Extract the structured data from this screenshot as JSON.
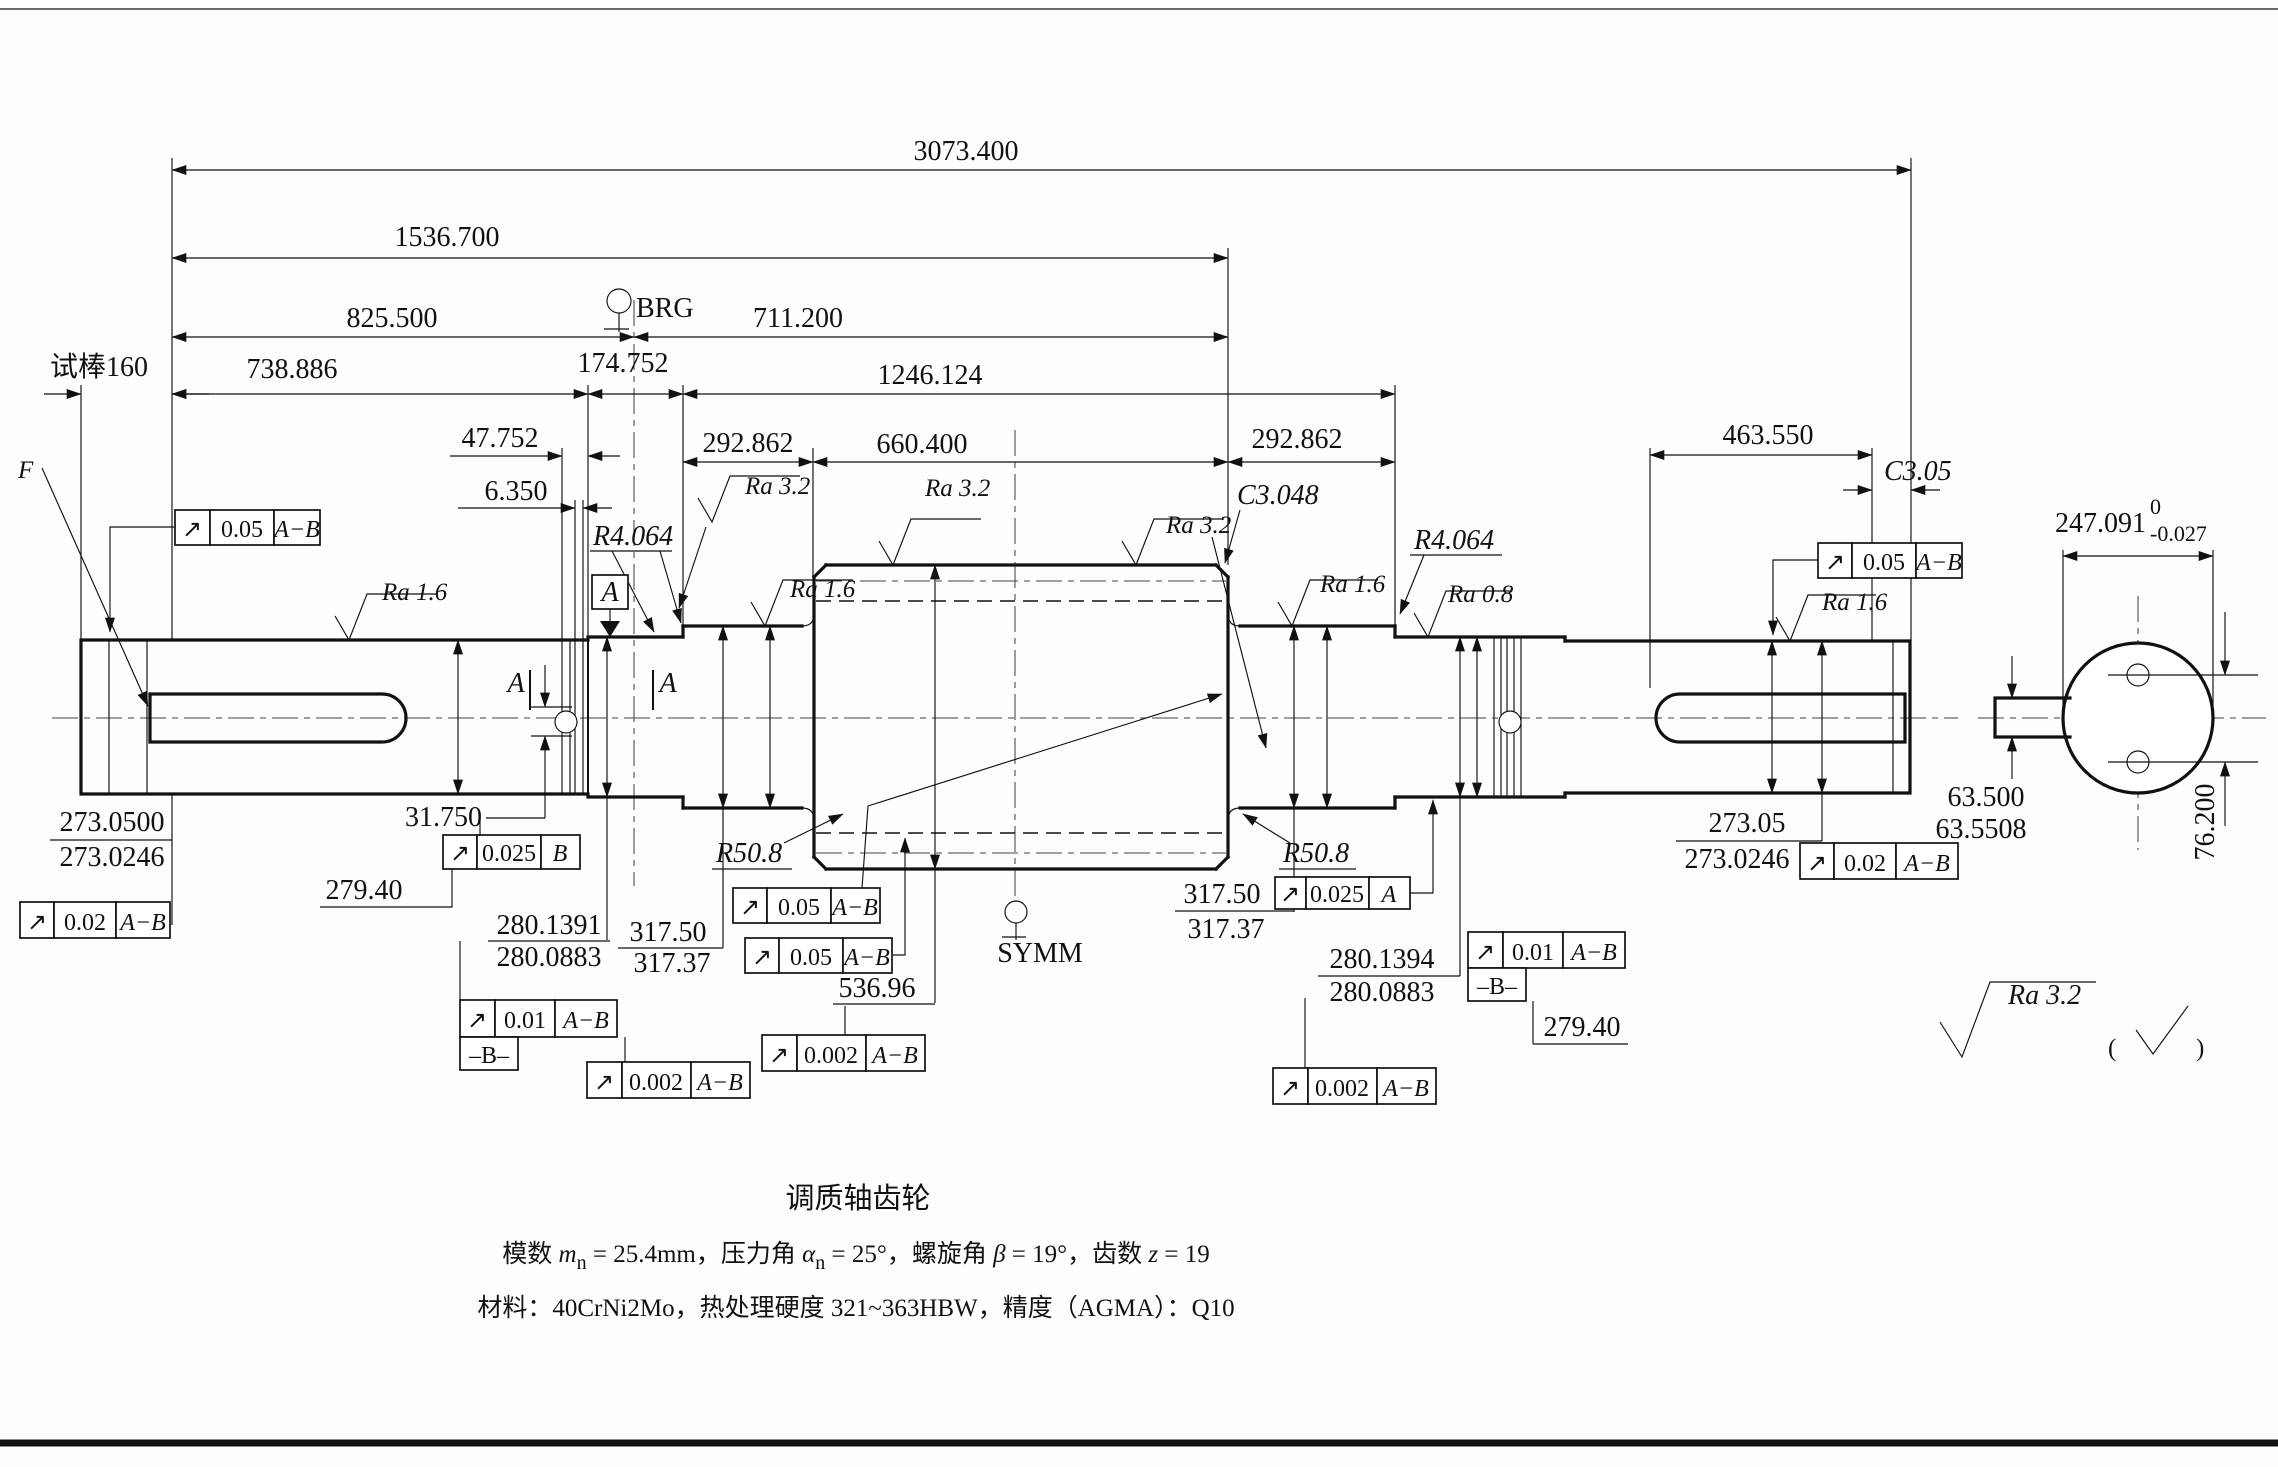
{
  "drawing": {
    "kind": "shaft-gear engineering drawing",
    "bg": "#fdfdfd",
    "ink": "#111111"
  },
  "t": {
    "d3073": "3073.400",
    "d1536": "1536.700",
    "d825": "825.500",
    "d711": "711.200",
    "brg": "BRG",
    "test": "试棒160",
    "d738": "738.886",
    "d174": "174.752",
    "d1246": "1246.124",
    "d47": "47.752",
    "d6": "6.350",
    "d292": "292.862",
    "d660": "660.400",
    "d463": "463.550",
    "c305": "C3.05",
    "c3048": "C3.048",
    "r4": "R4.064",
    "r50": "R50.8",
    "d247": "247.091",
    "d247sup": "0",
    "d247sub": "-0.027",
    "ra16": "Ra 1.6",
    "ra32": "Ra 3.2",
    "ra08": "Ra 0.8",
    "A": "A",
    "B": "B",
    "F": "F",
    "AB": "A−B",
    "btag": "–B–",
    "runout": "↗",
    "v005": "0.05",
    "v002": "0.02",
    "v0025": "0.025",
    "v001": "0.01",
    "v0002": "0.002",
    "d273hi": "273.0500",
    "d273lo": "273.0246",
    "d273Rhi": "273.05",
    "d31": "31.750",
    "d279": "279.40",
    "d280Lhi": "280.1391",
    "d280Rhi": "280.1394",
    "d280lo": "280.0883",
    "d317hi": "317.50",
    "d317lo": "317.37",
    "d536": "536.96",
    "d63hi": "63.500",
    "d63lo": "63.5508",
    "d76": "76.200",
    "symm": "SYMM",
    "popen": "(",
    "pclose": ")"
  },
  "title": {
    "l1": "调质轴齿轮",
    "l2a": "模数 ",
    "l2b": "m",
    "l2c": "n",
    "l2d": " = 25.4mm，压力角 ",
    "l2e": "α",
    "l2f": "n",
    "l2g": " = 25°，螺旋角 ",
    "l2h": "β",
    "l2i": " = 19°，齿数 ",
    "l2j": "z",
    "l2k": " = 19",
    "l3": "材料：40CrNi2Mo，热处理硬度 321~363HBW，精度（AGMA）：Q10"
  }
}
